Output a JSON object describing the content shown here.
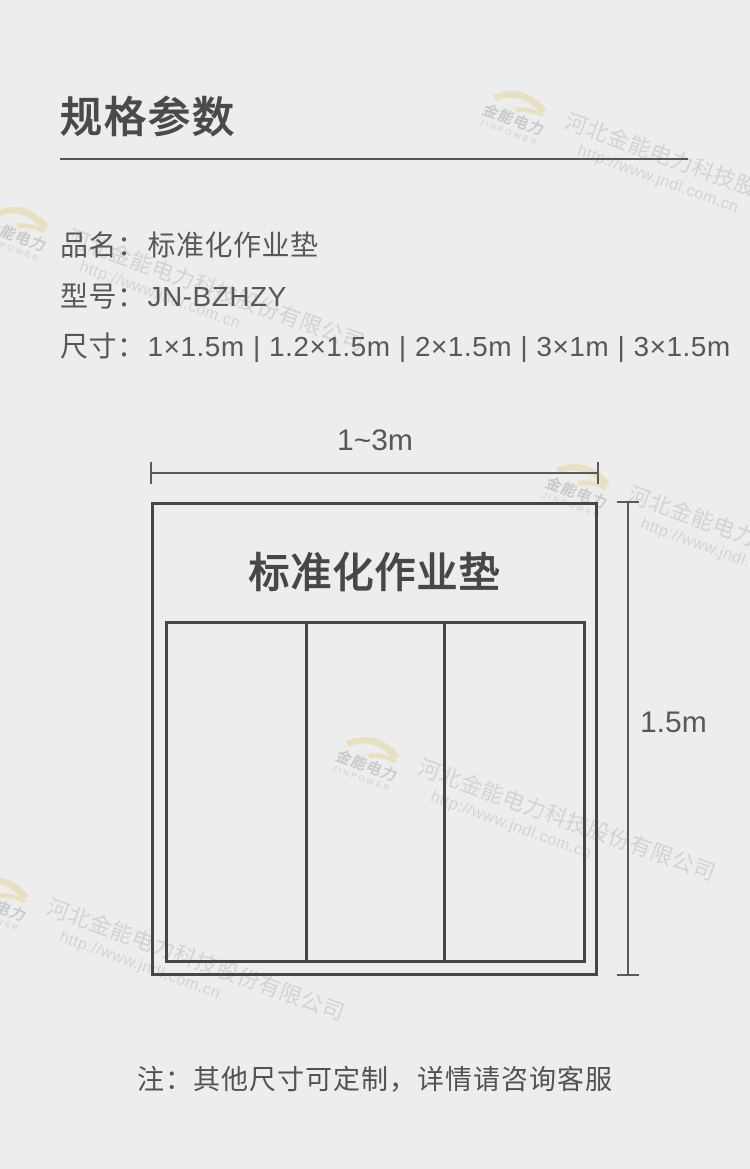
{
  "header": {
    "title": "规格参数"
  },
  "product_info": {
    "rows": [
      {
        "label": "品名：",
        "value": "标准化作业垫"
      },
      {
        "label": "型号：",
        "value": "JN-BZHZY"
      },
      {
        "label": "尺寸：",
        "value": "1×1.5m | 1.2×1.5m | 2×1.5m | 3×1m | 3×1.5m"
      }
    ]
  },
  "diagram": {
    "mat_title": "标准化作业垫",
    "width_label": "1~3m",
    "height_label": "1.5m",
    "columns": 3
  },
  "note": "注：其他尺寸可定制，详情请咨询客服",
  "watermark": {
    "logo_text": "金能电力",
    "logo_subtext": "JINPOWER",
    "company": "河北金能电力科技股份有限公司",
    "url": "http://www.jndl.com.cn"
  },
  "colors": {
    "background": "#ededed",
    "heading_text": "#4a4a4a",
    "body_text": "#58585a",
    "diagram_line": "#464646",
    "dimension_line": "#5a5a5a",
    "watermark_text": "#d3d3d3",
    "watermark_logo": "#e8e1c1"
  }
}
